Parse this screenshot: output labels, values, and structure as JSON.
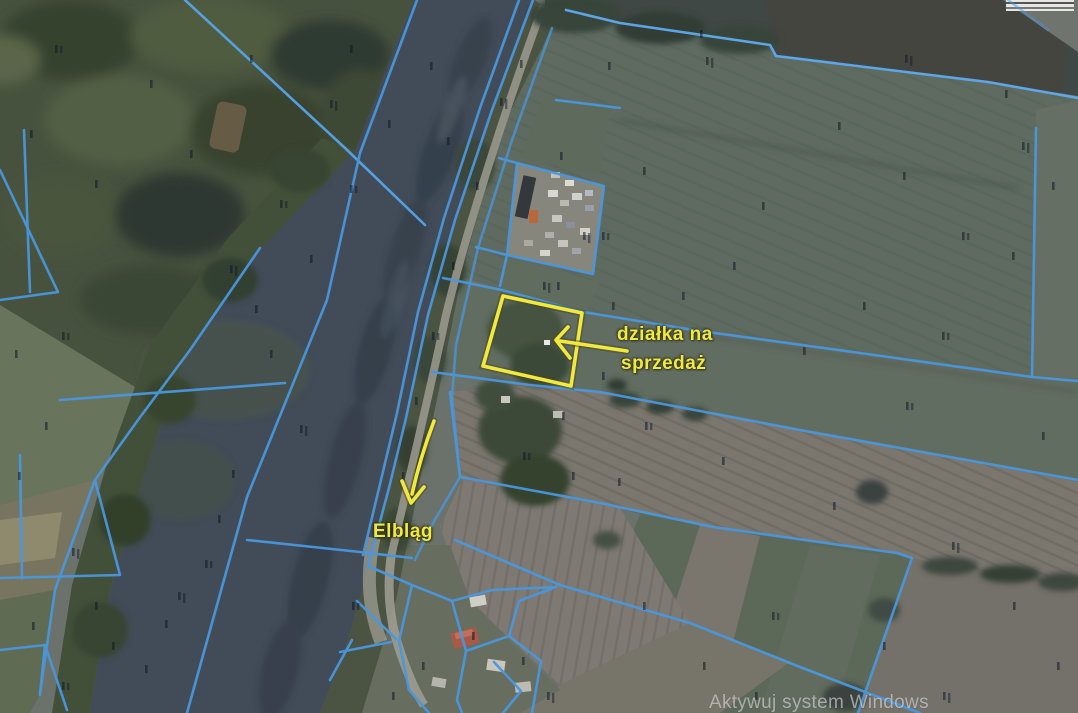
{
  "map": {
    "type": "satellite-cadastral",
    "labels": {
      "parcel": {
        "line1": "działka na",
        "line2": "sprzedaż"
      },
      "city": {
        "text": "Elbląg"
      }
    },
    "watermark": {
      "text": "Aktywuj system Windows"
    },
    "colors": {
      "annotation_yellow": "#f2e93e",
      "cadastral_line_blue": "#4a97dd",
      "river_water": "#414c58",
      "field_green": "#5f6b61",
      "field_gray_plowed": "#7b776f",
      "forest_green": "#47523e"
    }
  }
}
